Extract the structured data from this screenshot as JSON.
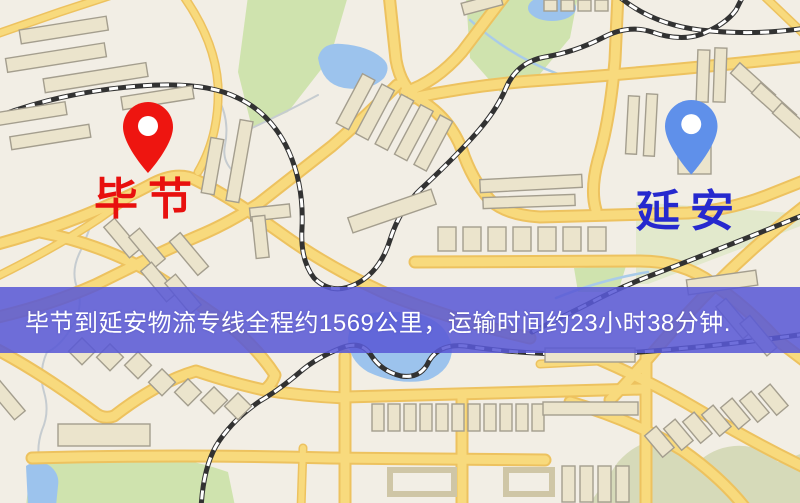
{
  "banner": {
    "text": "毕节到延安物流专线全程约1569公里，运输时间约23小时38分钟.",
    "background": "#5a5ad6",
    "text_color": "#ffffff"
  },
  "origin_marker": {
    "label": "毕节",
    "pin_color": "#ee1510",
    "label_color": "#e8100e"
  },
  "destination_marker": {
    "label": "延安",
    "pin_color": "#5f90ea",
    "label_color": "#2629ce"
  },
  "map_colors": {
    "base": "#f2eee5",
    "road": "#f8da7d",
    "road_casing": "#edc25f",
    "water": "#9cc3ed",
    "stream": "#c6ccd0",
    "park": "#cfe3ae",
    "park_muted": "#d6dab9",
    "building": "#ebe4cc",
    "building_stroke": "#a49e8e",
    "railway": "#323232",
    "railway_dash": "#ffffff"
  }
}
